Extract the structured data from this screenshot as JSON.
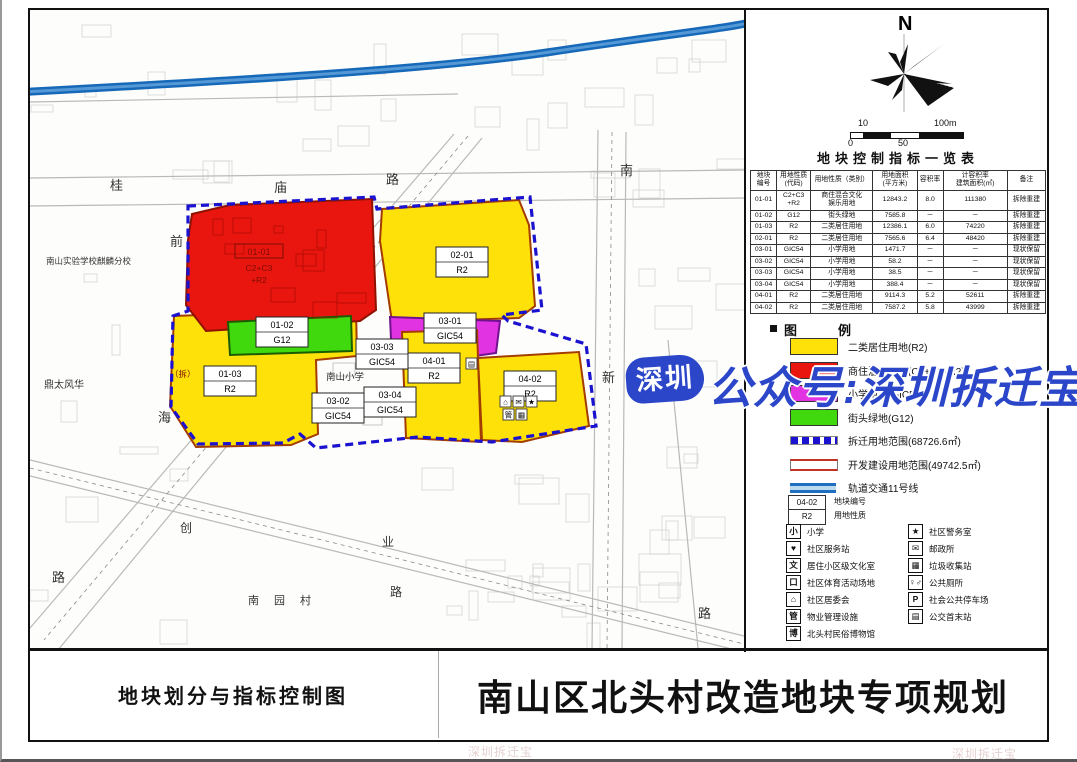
{
  "titles": {
    "drawing": "地块划分与指标控制图",
    "project": "南山区北头村改造地块专项规划"
  },
  "watermark": {
    "badge": "深圳",
    "text": "公众号:深圳拆迁宝",
    "faint": "深圳拆迁宝",
    "color": "#2b46c8"
  },
  "compass": {
    "north": "N"
  },
  "scalebar": {
    "top_left": "10",
    "top_right": "100m",
    "bottom_left": "0",
    "bottom_mid": "50"
  },
  "table": {
    "title": "地块控制指标一览表",
    "columns": [
      "地块\n编号",
      "用地性质\n(代码)",
      "用地性质（类别）",
      "用地面积\n(平方米)",
      "容积率",
      "计容积率\n建筑面积(㎡)",
      "备注"
    ],
    "rows": [
      [
        "01-01",
        "C2+C3\n+R2",
        "商住混合文化\n娱乐用地",
        "12843.2",
        "8.0",
        "111380",
        "拆除重建"
      ],
      [
        "01-02",
        "G12",
        "街头绿地",
        "7585.8",
        "－",
        "－",
        "拆除重建"
      ],
      [
        "01-03",
        "R2",
        "二类居住用地",
        "12386.1",
        "6.0",
        "74220",
        "拆除重建"
      ],
      [
        "02-01",
        "R2",
        "二类居住用地",
        "7565.6",
        "6.4",
        "48420",
        "拆除重建"
      ],
      [
        "03-01",
        "GIC54",
        "小学用地",
        "1471.7",
        "－",
        "－",
        "现状保留"
      ],
      [
        "03-02",
        "GIC54",
        "小学用地",
        "58.2",
        "－",
        "－",
        "现状保留"
      ],
      [
        "03-03",
        "GIC54",
        "小学用地",
        "38.5",
        "－",
        "－",
        "现状保留"
      ],
      [
        "03-04",
        "GIC54",
        "小学用地",
        "388.4",
        "－",
        "－",
        "现状保留"
      ],
      [
        "04-01",
        "R2",
        "二类居住用地",
        "9114.3",
        "5.2",
        "52611",
        "拆除重建"
      ],
      [
        "04-02",
        "R2",
        "二类居住用地",
        "7587.2",
        "5.8",
        "43999",
        "拆除重建"
      ]
    ]
  },
  "legend": {
    "title": "图　例",
    "items": [
      {
        "swatch": "fill",
        "color": "#ffe10a",
        "label": "二类居住用地(R2)"
      },
      {
        "swatch": "fill",
        "color": "#e8160f",
        "label": "商住混合用地(C2+C3+R2)"
      },
      {
        "swatch": "fill",
        "color": "#e233e2",
        "label": "小学用地(GIC54)"
      },
      {
        "swatch": "fill",
        "color": "#3fd90e",
        "label": "街头绿地(G12)"
      },
      {
        "swatch": "dashed",
        "color": "#1a12cf",
        "label": "拆迁用地范围(68726.6㎡)"
      },
      {
        "swatch": "double",
        "color": "#c23324",
        "label": "开发建设用地范围(49742.5㎡)"
      },
      {
        "swatch": "metro",
        "color": "#1f6fc0",
        "label": "轨道交通11号线"
      }
    ],
    "sample": {
      "code": "04-02",
      "type": "R2",
      "code_note": "地块编号",
      "type_note": "用地性质"
    }
  },
  "facilities": {
    "left": [
      {
        "icon": "小",
        "label": "小学"
      },
      {
        "icon": "♥",
        "label": "社区服务站"
      },
      {
        "icon": "文",
        "label": "居住小区级文化室"
      },
      {
        "icon": "口",
        "label": "社区体育活动场地"
      },
      {
        "icon": "⌂",
        "label": "社区居委会"
      },
      {
        "icon": "管",
        "label": "物业管理设施"
      },
      {
        "icon": "博",
        "label": "北头村民俗博物馆"
      }
    ],
    "right": [
      {
        "icon": "★",
        "label": "社区警务室"
      },
      {
        "icon": "✉",
        "label": "邮政所"
      },
      {
        "icon": "▦",
        "label": "垃圾收集站"
      },
      {
        "icon": "♀♂",
        "label": "公共厕所"
      },
      {
        "icon": "P",
        "label": "社会公共停车场"
      },
      {
        "icon": "▤",
        "label": "公交首末站"
      }
    ]
  },
  "map": {
    "metro_path": "M -6 82 C 180 72, 400 60, 520 42 S 700 18, 722 12",
    "demolition_boundary": "158,196 344,187 347,199 500,187 512,300 472,305 478,311 556,334 566,416 462,432 388,427 286,438 270,424 253,433 168,434 141,397 143,306 158,301",
    "parcels": [
      {
        "id": "01-03",
        "fill": "#ffe10a",
        "stroke": "#a33c00",
        "pts": "144,306 326,299 327,346 286,350 288,424 261,435 166,437 140,396"
      },
      {
        "id": "01-01",
        "fill": "#e8160f",
        "stroke": "#8f1200",
        "pts": "162,204 200,195 342,189 346,300 330,311 176,321 156,295 158,230"
      },
      {
        "id": "02-01",
        "fill": "#ffe10a",
        "stroke": "#a33c00",
        "pts": "352,199 489,190 499,215 505,296 489,308 362,312 350,231"
      },
      {
        "id": "01-02",
        "fill": "#3fd90e",
        "stroke": "#1c5c00",
        "pts": "198,312 321,306 322,341 200,345"
      },
      {
        "id": "03-01",
        "fill": "#e233e2",
        "stroke": "#70128f",
        "pts": "360,307 470,311 466,343 410,351 371,344 361,329"
      },
      {
        "id": "04-01",
        "fill": "#ffe10a",
        "stroke": "#a33c00",
        "pts": "372,322 447,320 451,432 376,428"
      },
      {
        "id": "04-02",
        "fill": "#ffe10a",
        "stroke": "#a33c00",
        "pts": "448,348 549,342 559,416 492,432 452,430"
      }
    ],
    "parcel_labels": [
      {
        "lines": [
          "02-01",
          "R2"
        ],
        "x": 432,
        "y": 252
      },
      {
        "lines": [
          "01-02",
          "G12"
        ],
        "x": 252,
        "y": 322
      },
      {
        "lines": [
          "01-03",
          "R2"
        ],
        "x": 200,
        "y": 371
      },
      {
        "lines": [
          "03-01",
          "GIC54"
        ],
        "x": 420,
        "y": 318
      },
      {
        "lines": [
          "03-03",
          "GIC54"
        ],
        "x": 352,
        "y": 344
      },
      {
        "lines": [
          "03-02",
          "GIC54"
        ],
        "x": 308,
        "y": 398
      },
      {
        "lines": [
          "03-04",
          "GIC54"
        ],
        "x": 360,
        "y": 392
      },
      {
        "lines": [
          "04-01",
          "R2"
        ],
        "x": 404,
        "y": 358
      },
      {
        "lines": [
          "04-02",
          "R2"
        ],
        "x": 500,
        "y": 376
      }
    ],
    "red_parcel_label": {
      "code": "01-01",
      "sub1": "C2+C3",
      "sub2": "+R2",
      "x": 229,
      "y": 242
    },
    "mini_icons": [
      {
        "x": 436,
        "y": 348,
        "g": "▤"
      },
      {
        "x": 470,
        "y": 386,
        "g": "⌂"
      },
      {
        "x": 483,
        "y": 386,
        "g": "✉"
      },
      {
        "x": 496,
        "y": 386,
        "g": "★"
      },
      {
        "x": 473,
        "y": 399,
        "g": "管"
      },
      {
        "x": 486,
        "y": 399,
        "g": "▦"
      }
    ],
    "labels": [
      {
        "t": "桂",
        "x": 80,
        "y": 180,
        "s": 13
      },
      {
        "t": "庙",
        "x": 244,
        "y": 182,
        "s": 13
      },
      {
        "t": "路",
        "x": 356,
        "y": 174,
        "s": 13
      },
      {
        "t": "前",
        "x": 140,
        "y": 236,
        "s": 13
      },
      {
        "t": "海",
        "x": 128,
        "y": 412,
        "s": 13
      },
      {
        "t": "路",
        "x": 22,
        "y": 572,
        "s": 13
      },
      {
        "t": "南",
        "x": 590,
        "y": 165,
        "s": 13
      },
      {
        "t": "新",
        "x": 572,
        "y": 372,
        "s": 13
      },
      {
        "t": "路",
        "x": 668,
        "y": 608,
        "s": 13
      },
      {
        "t": "创",
        "x": 150,
        "y": 522,
        "s": 12
      },
      {
        "t": "业",
        "x": 352,
        "y": 536,
        "s": 12
      },
      {
        "t": "路",
        "x": 360,
        "y": 586,
        "s": 12
      },
      {
        "t": "南",
        "x": 218,
        "y": 594,
        "s": 11
      },
      {
        "t": "园",
        "x": 244,
        "y": 594,
        "s": 11
      },
      {
        "t": "村",
        "x": 270,
        "y": 594,
        "s": 11
      },
      {
        "t": "南山实验学校麒麟分校",
        "x": 16,
        "y": 254,
        "s": 8.5
      },
      {
        "t": "鼎太风华",
        "x": 14,
        "y": 378,
        "s": 10
      },
      {
        "t": "南山小学",
        "x": 296,
        "y": 370,
        "s": 9.5
      },
      {
        "t": "（拆）",
        "x": 140,
        "y": 367,
        "s": 8.5,
        "c": "#7d0d00"
      }
    ]
  }
}
